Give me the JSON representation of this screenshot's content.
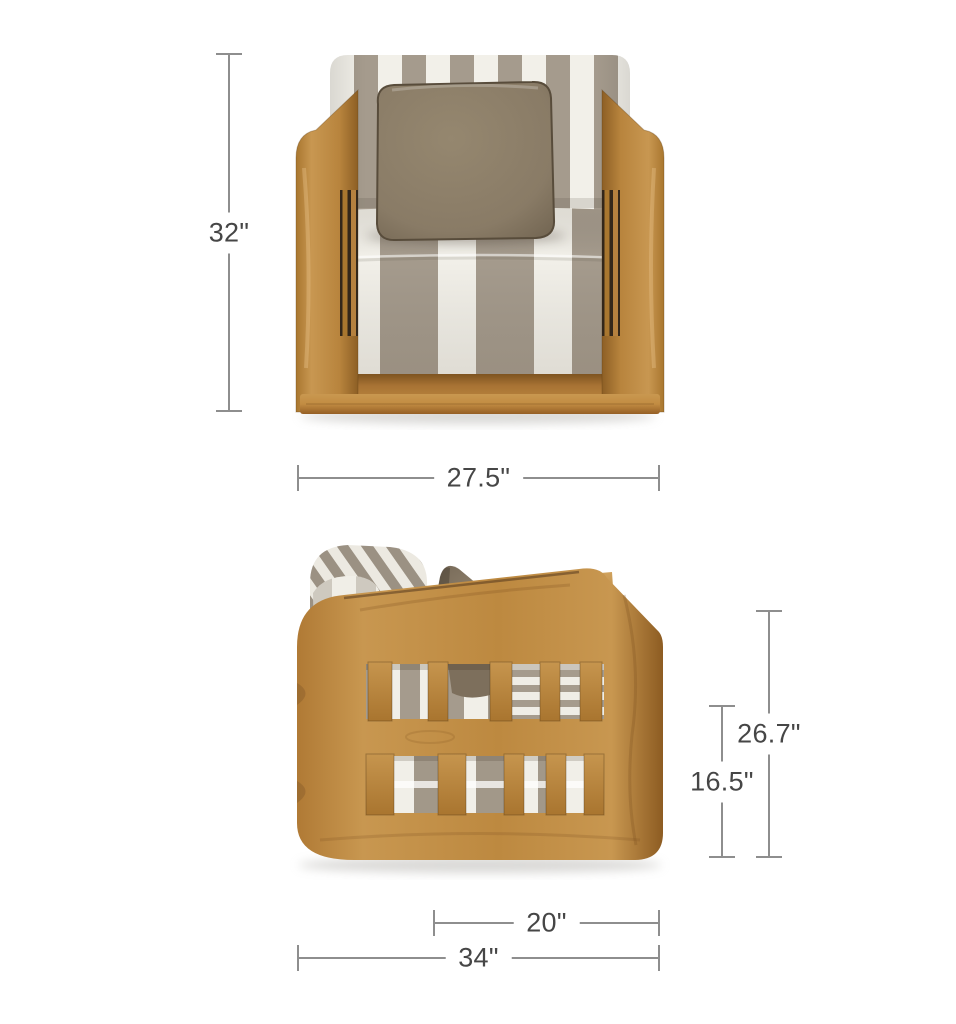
{
  "page": {
    "background": "#ffffff"
  },
  "figure": {
    "type": "product-dimensions-diagram",
    "subject": "Teak lounge armchair with gray-and-white striped cushions and a taupe throw pillow, shown in front and side views with dimension lines"
  },
  "front_view": {
    "name": "Front view",
    "dimensions": {
      "height": "32\"",
      "width": "27.5\""
    }
  },
  "side_view": {
    "name": "Side view",
    "dimensions": {
      "back_height": "26.7\"",
      "seat_height": "16.5\"",
      "seat_depth": "20\"",
      "overall_depth": "34\""
    }
  },
  "colors": {
    "dimension_line": "#8e8e8e",
    "dimension_text": "#464646",
    "teak_light": "#c99751",
    "teak_mid": "#b5813f",
    "teak_dark": "#8d5f25",
    "stripe_white": "#f2f0e9",
    "stripe_taupe": "#a59b8d",
    "pillow_taupe": "#897b66"
  }
}
